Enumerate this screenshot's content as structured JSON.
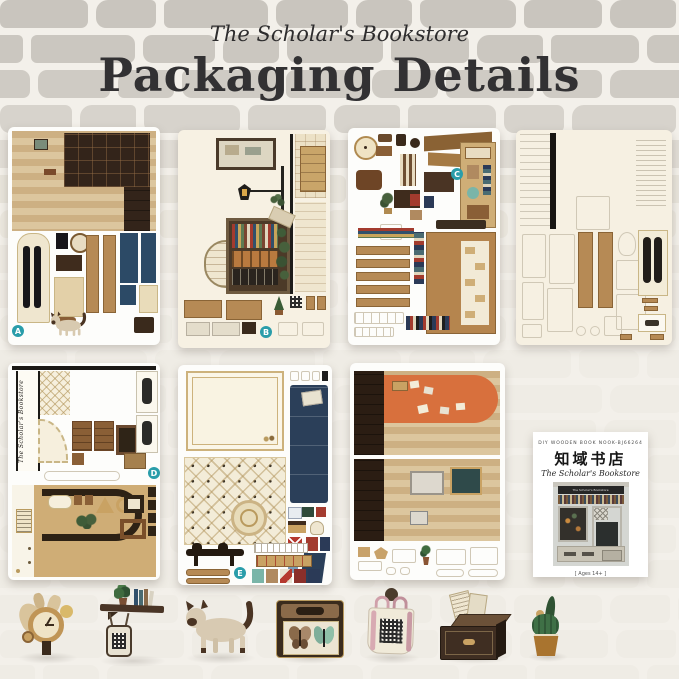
{
  "header": {
    "subtitle": "The Scholar's Bookstore",
    "title": "Packaging Details"
  },
  "sheets": {
    "a": {
      "label": "A",
      "name": "wallpaper and cabinet paper sheet"
    },
    "b": {
      "label": "B",
      "name": "storefront window and street lamp paper sheet"
    },
    "c": {
      "label": "C",
      "name": "shelves, books and props paper sheet"
    },
    "g": {
      "name": "die-cut chipboard sheet"
    },
    "d": {
      "label": "D",
      "sign_text": "The Scholar's Bookstore",
      "name": "shop sign and counter paper sheet"
    },
    "e": {
      "label": "E",
      "name": "tiled floor, frame and stamps paper sheet"
    },
    "f": {
      "name": "orange rug and wallpaper paper sheet"
    }
  },
  "booklet": {
    "top_line": "DIY WOODEN BOOK NOOK-BJ66264",
    "title_cn": "知域书店",
    "title_en": "The Scholar's Bookstore",
    "cover_sign": "The Scholar's Bookstore",
    "ages": "[ Ages 14+ ]"
  },
  "accessories": {
    "items": [
      "wooden wall clock",
      "wall shelf with plant and books",
      "hanging QR tag",
      "siamese cat figurine",
      "butterfly specimen box",
      "tote bag with QR code",
      "wooden chest with papers",
      "potted cactus"
    ]
  },
  "colors": {
    "badge_teal": "#2a9daa",
    "kraft_tan": "#cfad76",
    "navy": "#2b3f59",
    "rug_orange": "#d8703d",
    "dark_wood": "#33241a",
    "brick_gray": "#cbc7c0",
    "background": "#f3f0ea"
  }
}
